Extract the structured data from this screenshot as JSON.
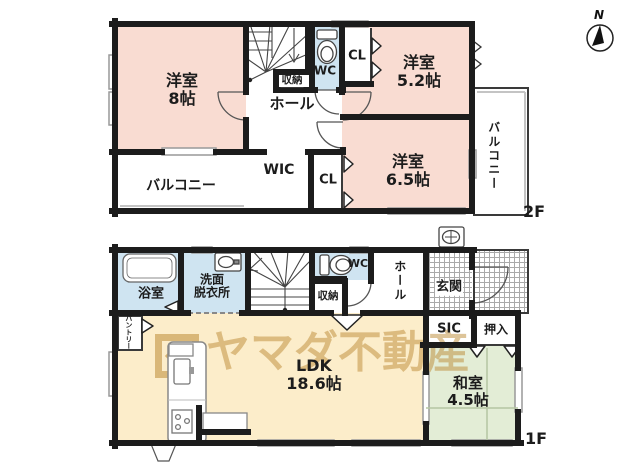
{
  "watermark": {
    "text": "ヤマダ不動産"
  },
  "compass": {
    "label": "N"
  },
  "floor2": {
    "label": "2F",
    "rooms": {
      "y8": "洋室\n8帖",
      "hall": "ホール",
      "shuno": "収納",
      "wc": "WC",
      "cl_a": "CL",
      "y52": "洋室\n5.2帖",
      "wic": "WIC",
      "cl_b": "CL",
      "y65": "洋室\n6.5帖",
      "balcony_l": "バルコニー",
      "balcony_r": "バルコニー"
    }
  },
  "floor1": {
    "label": "1F",
    "rooms": {
      "bath": "浴室",
      "senmen": "洗面\n脱衣所",
      "shuno": "収納",
      "wc": "WC",
      "hall": "ホール",
      "genkan": "玄関",
      "sic": "SIC",
      "oshiire": "押入",
      "washitsu": "和室\n4.5帖",
      "ldk": "LDK\n18.6帖",
      "pantry": "パントリー"
    }
  },
  "colors": {
    "wall": "#1c1c1c",
    "western_room": "#f9dcd2",
    "wet_area": "#cfe4f1",
    "ldk": "#fcedca",
    "tatami": "#e3edd6",
    "watermark": "#bb8a34"
  }
}
